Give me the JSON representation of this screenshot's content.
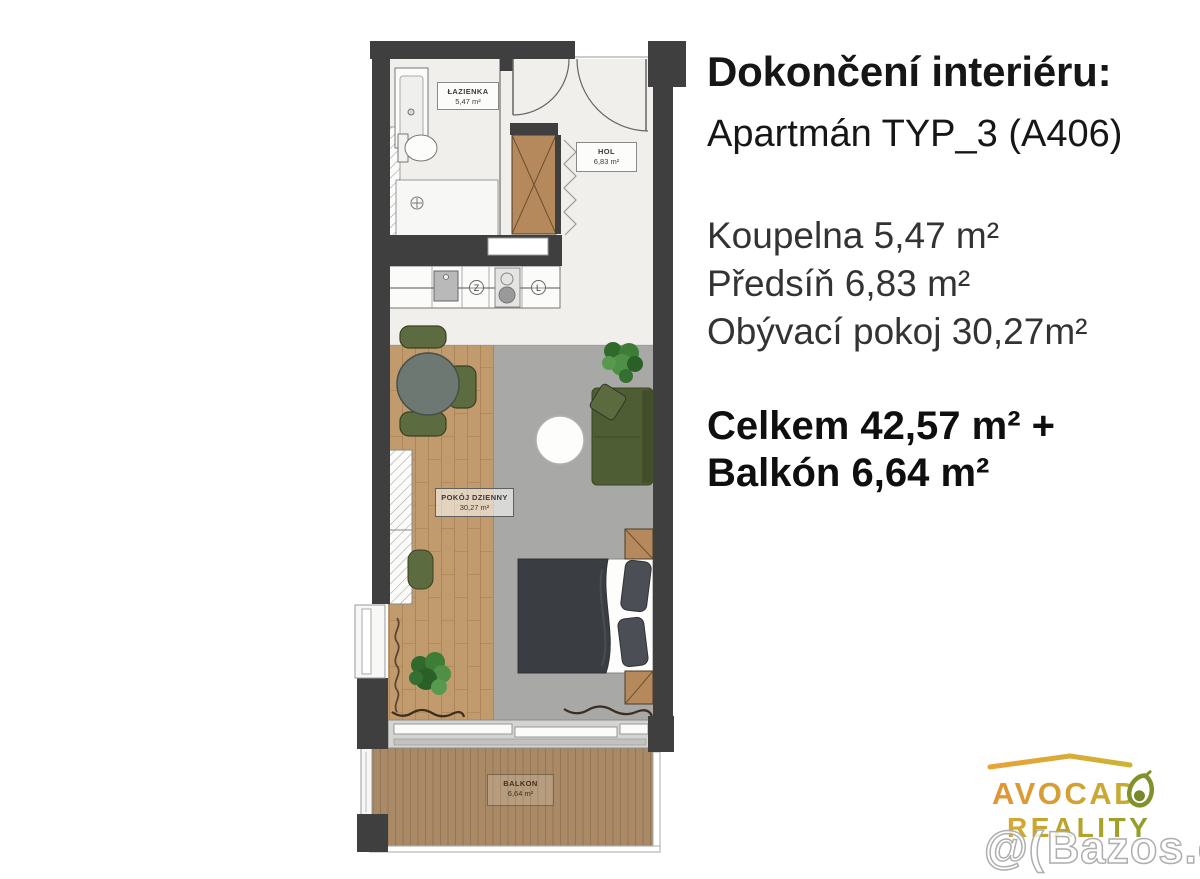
{
  "info_panel": {
    "title": "Dokončení interiéru:",
    "subtitle": "Apartmán TYP_3 (A406)",
    "rooms": [
      "Koupelna 5,47 m²",
      "Předsíň 6,83 m²",
      "Obývací pokoj 30,27m²"
    ],
    "total_line1": "Celkem 42,57 m² +",
    "total_line2": "Balkón 6,64 m²"
  },
  "floor_plan": {
    "bathroom": {
      "name": "ŁAZIENKA",
      "area": "5,47 m²"
    },
    "hall": {
      "name": "HOL",
      "area": "6,83 m²"
    },
    "living_room": {
      "name": "POKÓJ DZIENNY",
      "area": "30,27 m²"
    },
    "balcony": {
      "name": "BALKON",
      "area": "6,64 m²"
    },
    "kitchen": {
      "dishwasher_symbol": "Z",
      "fridge_symbol": "L"
    }
  },
  "branding": {
    "brand_name": "AVOCADO REALITY",
    "logo_line1": "AVOCADO",
    "logo_line1_display": "AVOCAD",
    "logo_line2": "REALITY",
    "watermark_mark": "@(",
    "watermark_text": "Bazos.cz"
  },
  "colors": {
    "wall": "#3f3f3f",
    "marble_floor": "#f0efec",
    "wood_floor": "#c19b6d",
    "concrete_floor": "#a8a9a7",
    "balcony_deck": "#aa8a66",
    "furniture_olive": "#55663a",
    "bed_duvet": "#3a3d42",
    "logo_orange": "#e09738",
    "logo_yellow": "#cfb033",
    "avocado_green": "#7f922c",
    "text_dark": "#161616"
  }
}
